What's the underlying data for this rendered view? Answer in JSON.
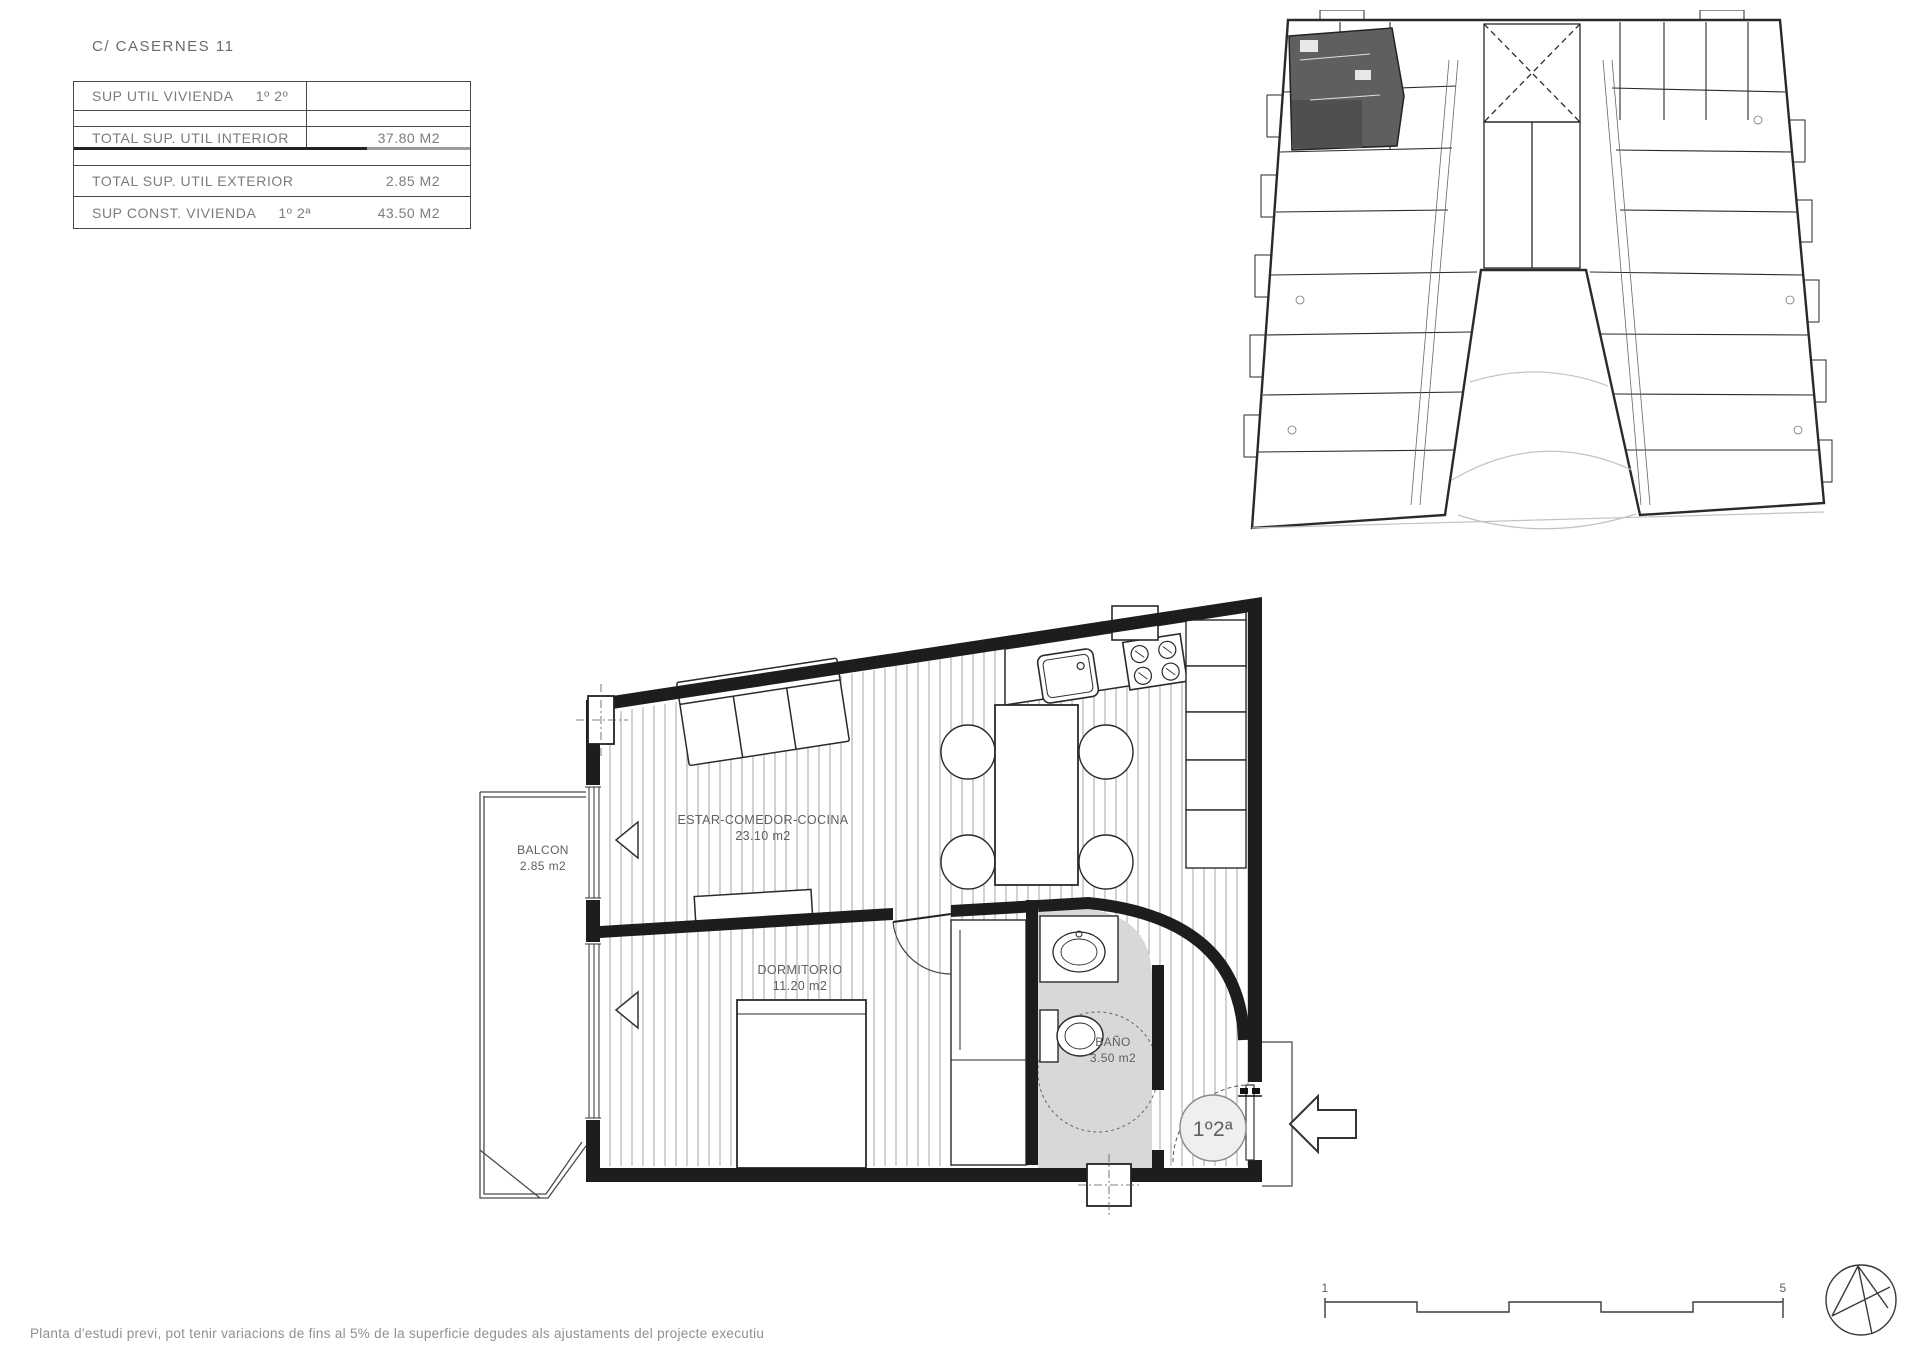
{
  "page": {
    "title": "C/ CASERNES 11",
    "footer": "Planta d'estudi previ, pot tenir variacions de fins al 5% de la superficie degudes als ajustaments del projecte executiu"
  },
  "area_table": {
    "rows": [
      {
        "label": "SUP UTIL VIVIENDA",
        "sub": "1º 2º",
        "value": ""
      },
      {
        "label": "TOTAL SUP. UTIL INTERIOR",
        "sub": "",
        "value": "37.80 M2"
      },
      {
        "label": "TOTAL SUP. UTIL EXTERIOR",
        "sub": "",
        "value": "2.85 M2"
      },
      {
        "label": "SUP CONST. VIVIENDA",
        "sub": "1º 2ª",
        "value": "43.50 M2"
      }
    ]
  },
  "floor_plan": {
    "rooms": [
      {
        "name": "BALCON",
        "area": "2.85 m2"
      },
      {
        "name": "ESTAR-COMEDOR-COCINA",
        "area": "23.10 m2"
      },
      {
        "name": "DORMITORIO",
        "area": "11.20 m2"
      },
      {
        "name": "BAÑO",
        "area": "3.50 m2"
      }
    ],
    "unit_label": "1º2ª"
  },
  "scale_bar": {
    "start": "1",
    "end": "5"
  },
  "colors": {
    "ink": "#1d1d1d",
    "line_gray": "#9a9a9a",
    "bath_fill": "#d8d8d8",
    "highlight_unit": "#5f5f5f",
    "text_gray": "#7a7a7a"
  }
}
